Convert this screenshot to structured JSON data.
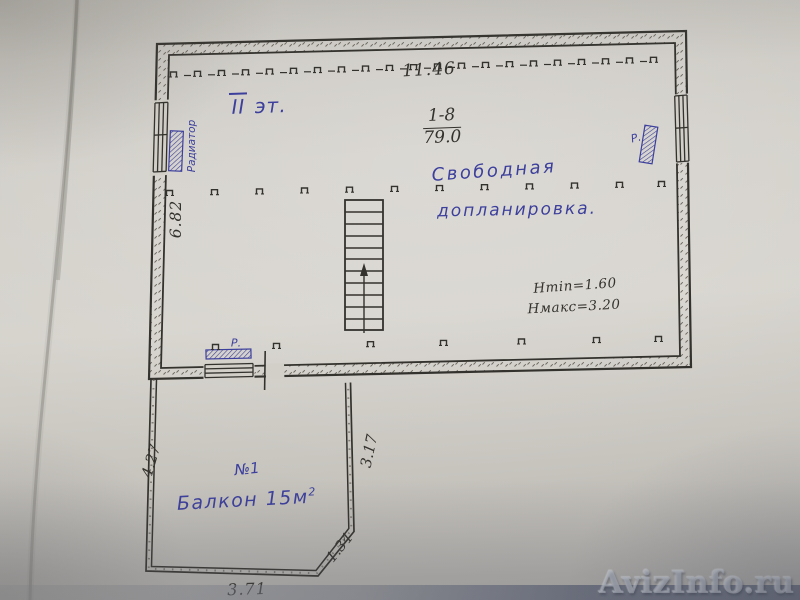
{
  "colors": {
    "ink": "#34322d",
    "pen_blue": "#3c3f9c",
    "paper": "#d2cfc9",
    "strip": "#6d7384"
  },
  "plan": {
    "floor_roman": "II",
    "floor_suffix": " эт.",
    "dim_top": "11.46",
    "room_number": "1-8",
    "room_area": "79.0",
    "note_line1": "Свободная",
    "note_line2": "допланировка.",
    "h_min": "Hmin=1.60",
    "h_max": "Hмакс=3.20",
    "dim_left": "6.82",
    "radiator_left": "Радиатор",
    "radiator_right": "Р.",
    "radiator_bottom": "Р."
  },
  "balcony": {
    "number": "№1",
    "label": "Балкон 15м",
    "label_sup": "2",
    "dim_left": "4.27",
    "dim_right": "3.17",
    "dim_chamfer": "1.34",
    "dim_bottom": "3.71"
  },
  "watermark": "AvizInfo.ru"
}
